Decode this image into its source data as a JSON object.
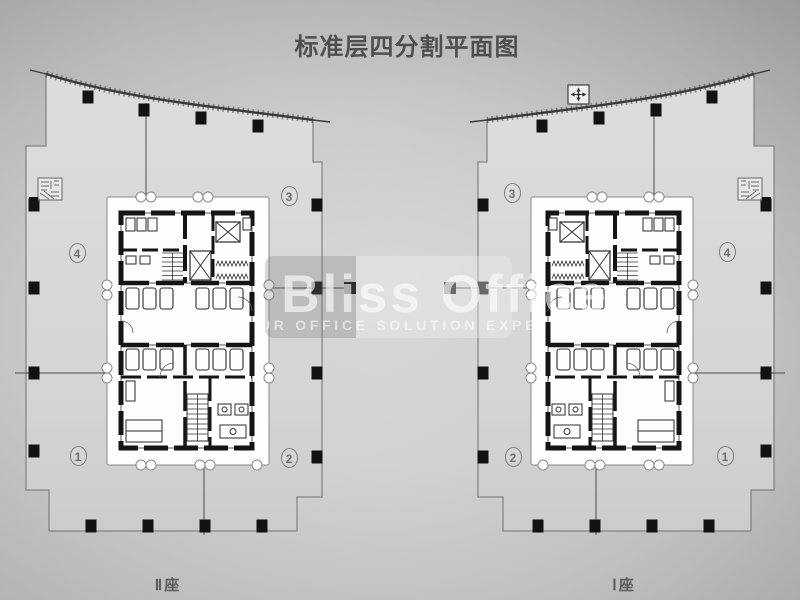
{
  "title": "标准层四分割平面图",
  "watermark": {
    "brand": "Bliss Office",
    "tagline": "UR OFFICE SOLUTION EXPE"
  },
  "towers": {
    "tower2": {
      "label": "Ⅱ座",
      "position": "left"
    },
    "tower1": {
      "label": "Ⅰ座",
      "position": "right"
    }
  },
  "zones": {
    "z1": "1",
    "z2": "2",
    "z3": "3",
    "z4": "4"
  },
  "icons": {
    "compass": "compass-rose",
    "corner_block": "stair-core-detail"
  },
  "colors": {
    "background": "#c6c6c4",
    "floor_plate": "#d8d8d6",
    "core_wall": "#141414",
    "watermark_text": "#ffffff",
    "zone_marker": "#7d7d7d",
    "title_text": "#4f4f4f"
  }
}
